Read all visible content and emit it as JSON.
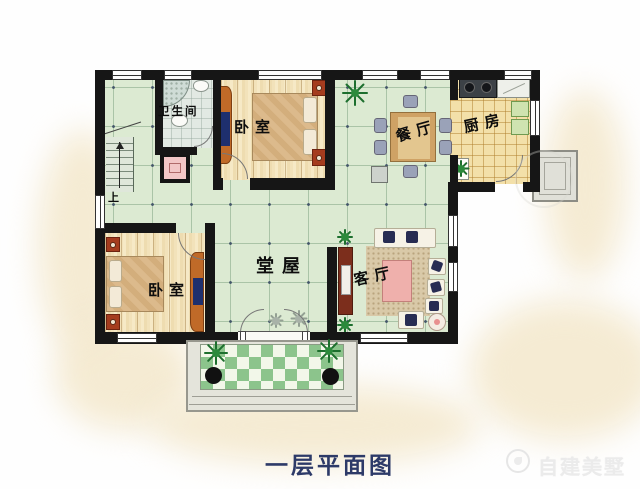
{
  "caption": "一层平面图",
  "brand": {
    "name": "自建美墅"
  },
  "stairs": {
    "up_label": "上"
  },
  "rooms": {
    "bathroom": {
      "label": "卫生间"
    },
    "bedroom_top": {
      "label": "卧室"
    },
    "dining": {
      "label": "餐厅"
    },
    "kitchen": {
      "label": "厨房"
    },
    "hall": {
      "label": "堂屋"
    },
    "bedroom_bottom": {
      "label": "卧室"
    },
    "living": {
      "label": "客厅"
    }
  },
  "colors": {
    "wall": "#161616",
    "hall_floor": "#dcead2",
    "wood_floor": "#f2e2ba",
    "kitchen_floor": "#f3e0a9",
    "bath_floor": "#e2e9e3",
    "porch_green": "#8cc48c",
    "caption_text": "#2d3a68",
    "wardrobe_orange": "#c06a28",
    "nightstand_red": "#a53c1e",
    "sofa_pillow_navy": "#272c52",
    "coffee_table_pink": "#efb0ac"
  }
}
